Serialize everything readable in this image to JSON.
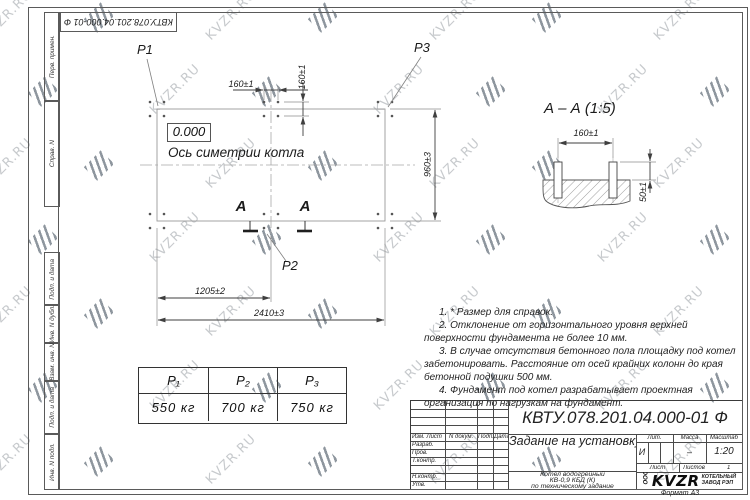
{
  "watermark": {
    "text": "KVZR.RU"
  },
  "frame": {
    "top_stamp": "КВТУ.078.201.04.000-01 Ф",
    "side_labels": [
      "Перв. примен.",
      "Справ. N",
      "Подп. и дата",
      "Инв. N дубл.",
      "Взам. инв. N",
      "Подп. и дата",
      "Инв. N подл."
    ],
    "format_note": "Формат А3"
  },
  "plan": {
    "point_labels": {
      "p1": "P1",
      "p2": "P2",
      "p3": "P3"
    },
    "elevation": "0.000",
    "axis_label": "Ось симетрии котла",
    "dims": {
      "bolt_x": "160±1",
      "bolt_y": "160±1",
      "width": "960±3",
      "half_length": "1205±2",
      "length": "2410±3"
    },
    "section_letter": "А"
  },
  "section": {
    "title": "А – А (1:5)",
    "dims": {
      "bolt_spacing": "160±1",
      "bolt_height": "50±1"
    }
  },
  "notes": [
    "1. * Размер для справок.",
    "2. Отклонение от горизонтального уровня верхней поверхности фундамента не более 10 мм.",
    "3. В случае отсутствия бетонного пола площадку под котел забетонировать. Расстояние от осей крайних колонн до края бетонной подушки 500 мм.",
    "4. Фундамент под котел разрабатывает проектная организация по нагрузкам на фундамент."
  ],
  "load_table": {
    "headers": [
      "P₁",
      "P₂",
      "P₃"
    ],
    "values": [
      "550 кг",
      "700 кг",
      "750 кг"
    ]
  },
  "title_block": {
    "designation": "КВТУ.078.201.04.000-01 Ф",
    "doc_title": "Задание на установку фундамента",
    "product": [
      "Котел водогрейный",
      "КВ-0,9 КБД (К)",
      "по техническому задание"
    ],
    "change_header": [
      "Изм. Лист",
      "N докум.",
      "Подп.",
      "Дата"
    ],
    "sign_rows": [
      "Разраб.",
      "Пров.",
      "Т.контр.",
      "Н.контр.",
      "Утв."
    ],
    "lit_label": "Лит.",
    "lit_value": "И",
    "mass_label": "Масса",
    "mass_value": "–",
    "scale_label": "Масштаб",
    "scale_value": "1:20",
    "sheet_label": "Лист",
    "sheets_label": "Листов",
    "sheets_value": "1",
    "company_prefix": "ООО",
    "logo": "KVZR",
    "company": [
      "КОТЕЛЬНЫЙ",
      "ЗАВОД РЭП"
    ]
  }
}
